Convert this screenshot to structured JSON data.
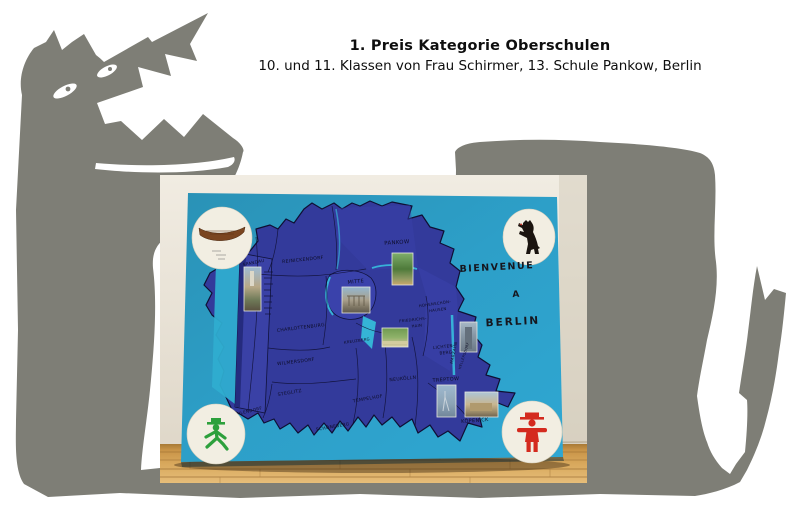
{
  "header": {
    "title": "1. Preis Kategorie Oberschulen",
    "subtitle": "10. und 11. Klassen von Frau Schirmer, 13. Schule Pankow, Berlin"
  },
  "poster": {
    "welcome": {
      "line1": "BIENVENUE",
      "line2": "A",
      "line3": "BERLIN"
    },
    "districts": [
      {
        "label": "SPANDAU"
      },
      {
        "label": "REINICKENDORF"
      },
      {
        "label": "PANKOW"
      },
      {
        "label": "MITTE"
      },
      {
        "label": "CHARLOTTENBURG"
      },
      {
        "label": "WILMERSDORF"
      },
      {
        "label": "STEGLITZ"
      },
      {
        "label": "ZEHLENDORF"
      },
      {
        "label": "SCHÖNEBERG"
      },
      {
        "label": "TEMPELHOF"
      },
      {
        "label": "NEUKÖLLN"
      },
      {
        "label": "KREUZBERG"
      },
      {
        "label": "FRIEDRICHS-"
      },
      {
        "label": "HAIN"
      },
      {
        "label": "HOHENSCHÖN-"
      },
      {
        "label": "HAUSEN"
      },
      {
        "label": "LICHTEN-"
      },
      {
        "label": "BERG"
      },
      {
        "label": "MARZAHN"
      },
      {
        "label": "HELLERSDORF"
      },
      {
        "label": "TREPTOW"
      },
      {
        "label": "KÖPENICK"
      }
    ]
  },
  "colors": {
    "wolf_gray": "#7e7e76",
    "board_blue": "#2d9dc6",
    "map_blue": "#333a9b",
    "fold_teal": "#38bede",
    "ampelmann_green": "#2da03c",
    "ampelmann_red": "#d42a1e",
    "bear_black": "#1b140f",
    "boat_brown": "#7a4520",
    "floor_wood": "#cf9c52"
  }
}
